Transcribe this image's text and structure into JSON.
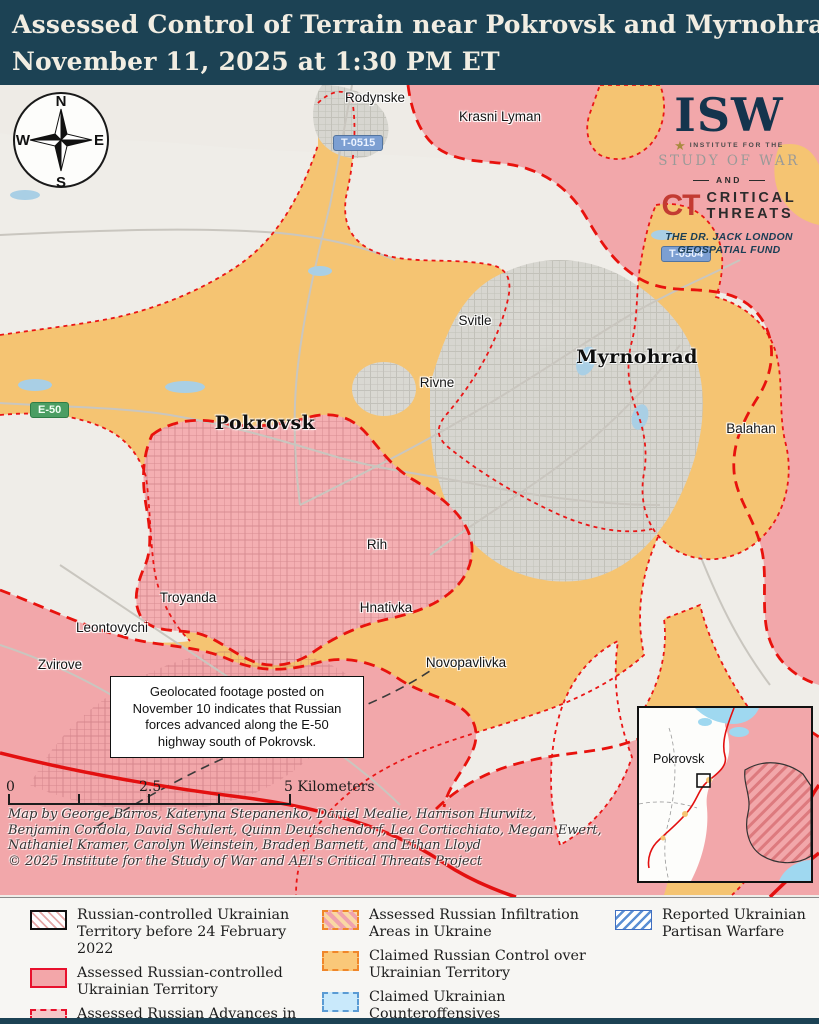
{
  "header": {
    "title_line1": "Assessed Control of Terrain near Pokrovsk and Myrnohrad",
    "title_line2": "November 11, 2025 at 1:30 PM ET"
  },
  "compass": {
    "north": "N",
    "east": "E",
    "south": "S",
    "west": "W"
  },
  "logo": {
    "isw": "ISW",
    "institute_line": "INSTITUTE FOR THE",
    "study_line": "STUDY OF WAR",
    "and": "AND",
    "ct": "CT",
    "critical": "CRITICAL",
    "threats": "THREATS",
    "fund_line1": "THE DR. JACK LONDON",
    "fund_line2": "GEOSPATIAL FUND"
  },
  "map": {
    "city_labels": [
      {
        "text": "Pokrovsk"
      },
      {
        "text": "Myrnohrad"
      }
    ],
    "town_labels": [
      {
        "text": "Rodynske"
      },
      {
        "text": "Krasni Lyman"
      },
      {
        "text": "Svitle"
      },
      {
        "text": "Rivne"
      },
      {
        "text": "Balahan"
      },
      {
        "text": "Rih"
      },
      {
        "text": "Hnativka"
      },
      {
        "text": "Troyanda"
      },
      {
        "text": "Leontovychi"
      },
      {
        "text": "Zvirove"
      },
      {
        "text": "Novopavlivka"
      }
    ],
    "road_shields": [
      {
        "text": "T-0515"
      },
      {
        "text": "T-0504"
      },
      {
        "text": "E-50"
      }
    ],
    "annotation": "Geolocated footage posted on November 10 indicates that Russian forces advanced along the E-50 highway south of Pokrovsk.",
    "scale_bar": {
      "tick0": "0",
      "tick1": "2.5",
      "tick2": "5 Kilometers"
    },
    "credits_line1": "Map by George Barros, Kateryna Stepanenko, Daniel Mealie, Harrison Hurwitz,",
    "credits_line2": "Benjamin Cordola, David Schulert, Quinn Deutschendorf, Lea Corticchiato, Megan Ewert,",
    "credits_line3": "Nathaniel Kramer, Carolyn Weinstein, Braden Barnett, and Ethan Lloyd",
    "credits_line4": "© 2025 Institute for the Study of War and AEI's Critical Threats Project",
    "inset": {
      "label": "Pokrovsk"
    }
  },
  "legend": {
    "items": [
      {
        "label": "Russian-controlled Ukrainian Territory before 24 February 2022"
      },
      {
        "label": "Assessed Russian-controlled Ukrainian Territory"
      },
      {
        "label": "Assessed Russian Advances in Ukraine"
      },
      {
        "label": "Assessed Russian Infiltration Areas in Ukraine"
      },
      {
        "label": "Claimed Russian Control over Ukrainian Territory"
      },
      {
        "label": "Claimed Ukrainian Counteroffensives"
      },
      {
        "label": "Reported Ukrainian Partisan Warfare"
      }
    ]
  },
  "colors": {
    "header_bg": "#1C4254",
    "terrain": "#EFEDE8",
    "claimed_russian_orange": "#F5C472",
    "assessed_russian_pink": "#F2A7AA",
    "advance_red_line": "#E8120D",
    "urban_gray": "#D7D6D0",
    "water_blue": "#A9CFE5"
  }
}
